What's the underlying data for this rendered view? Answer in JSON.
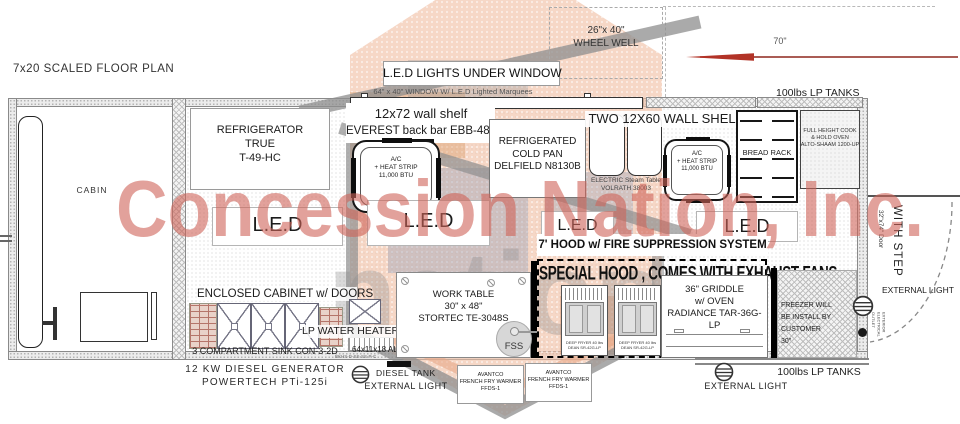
{
  "title": "7x20 SCALED FLOOR PLAN",
  "watermark": {
    "primary": "Concession Nation, Inc.",
    "secondary": "nation",
    "accent_color": "#d4756a",
    "logo_salmon": "#f1bfa3",
    "logo_gray": "#8e8e8e"
  },
  "window": {
    "led_lights": "L.E.D LIGHTS UNDER WINDOW",
    "window_label": "64\" x 40\" WINDOW W/ L.E.D Lighted Marquees"
  },
  "exterior": {
    "wheel_well": "26\"x 40\"\nWHEEL WELL",
    "distance_70": "70\"",
    "lp_tanks": "100lbs LP TANKS",
    "external_light": "EXTERNAL LIGHT",
    "diesel_tank": "DIESEL TANK",
    "generator": "12 KW DIESEL GENERATOR\nPOWERTECH PTi-125i",
    "with_step": "WITH STEP",
    "door": "32\"x74\" Door",
    "electrical_outlet": "EXTERIOR\nELECTRICAL\nOUTLET"
  },
  "cabin": {
    "label": "CABIN"
  },
  "equipment": {
    "refrigerator": "REFRIGERATOR\nTRUE\nT-49-HC",
    "wall_shelf": "12x72 wall shelf",
    "back_bar": "EVEREST back bar EBB-48-24",
    "ac_unit": "A/C\n+ HEAT STRIP\n11,000 BTU",
    "cold_pan": "REFRIGERATED\nCOLD PAN\nDELFIELD N8130B",
    "two_wall_shelf": "TWO 12X60 WALL SHELF",
    "steam_table": "ELECTRIC Steam Table\nVOLRATH 38003",
    "bread_rack": "BREAD RACK",
    "cook_hold_oven": "FULL HEIGHT COOK\n& HOLD OVEN\nALTO-SHAAM 1200-UP",
    "led": "L.E.D",
    "hood": "7' HOOD w/ FIRE SUPPRESSION SYSTEM",
    "special_hood": "SPECIAL HOOD , COMES WITH EXHAUST FANS",
    "griddle": "36\" GRIDDLE\nw/ OVEN\nRADIANCE TAR-36G-LP",
    "freezer_note": "FREEZER WILL\nBE INSTALL BY CUSTOMER\n30\"",
    "fryer": "DEEP FRYER 40 lbs\nDEAN SR-42G-LP",
    "enclosed_cabinet": "ENCLOSED CABINET w/ DOORS",
    "water_heater": "LP WATER HEATER",
    "sink": "3 COMPARTMENT SINK  CON-3-2D",
    "aluminum_cabinets": "64x11x18 ALUMINUM CABINETS",
    "cabinet_part_no": "BKHS-D-SS-SS-P-C",
    "work_table": "WORK TABLE\n30\" x 48\"\nSTORTEC   TE-3048S",
    "fss": "FSS",
    "fry_warmer": "AVANTCO\nFRENCH FRY WARMER\nFFDS-1"
  }
}
